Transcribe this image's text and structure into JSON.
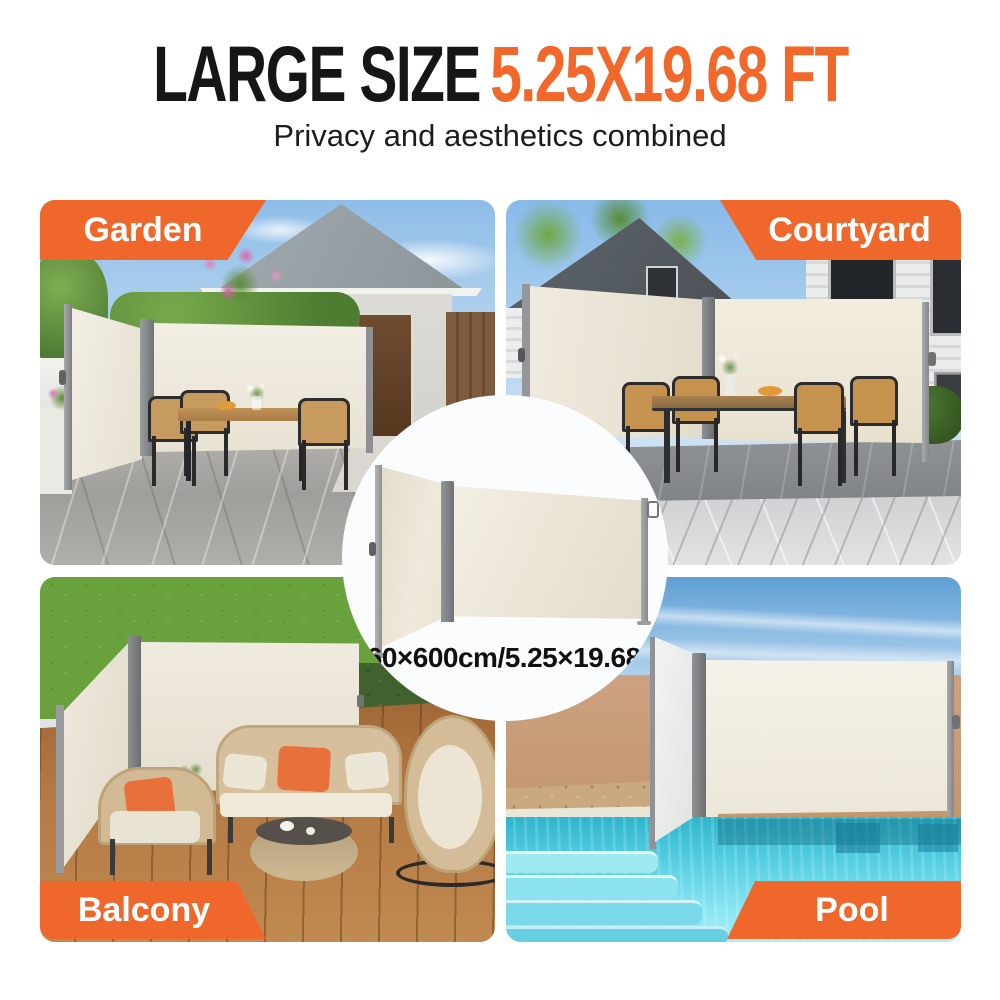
{
  "header": {
    "title_size": "LARGE SIZE",
    "title_dimensions": "5.25X19.68 FT",
    "subtitle": "Privacy and aesthetics combined"
  },
  "center_badge": {
    "dimension_text": "160×600cm/5.25×19.68ft"
  },
  "scenes": [
    {
      "id": "garden",
      "label": "Garden",
      "label_position": "top-left"
    },
    {
      "id": "courtyard",
      "label": "Courtyard",
      "label_position": "top-right"
    },
    {
      "id": "balcony",
      "label": "Balcony",
      "label_position": "bottom-left"
    },
    {
      "id": "pool",
      "label": "Pool",
      "label_position": "bottom-right"
    }
  ],
  "colors": {
    "accent_orange": "#F0672C",
    "title_orange": "#F2672A",
    "title_black": "#161616",
    "label_text": "#FFFFFF",
    "awning_fabric_cream": "#ECE6D8",
    "frame_gray": "#808285",
    "badge_background": "#FBFCFD"
  }
}
